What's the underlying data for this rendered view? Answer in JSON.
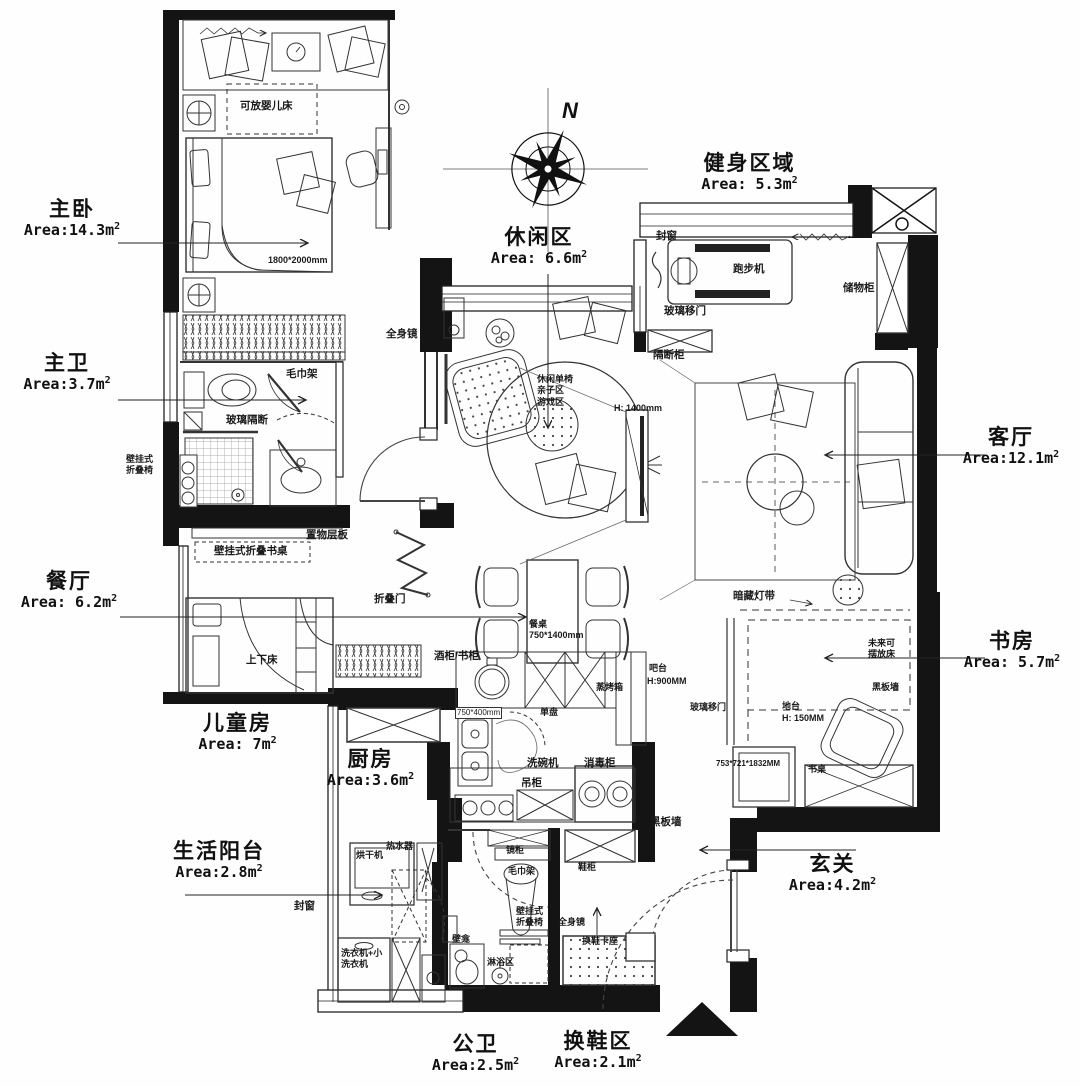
{
  "compass": {
    "north": "N"
  },
  "rooms": {
    "master_bedroom": {
      "name": "主卧",
      "area": "Area:14.3m",
      "sup": "2"
    },
    "master_bath": {
      "name": "主卫",
      "area": "Area:3.7m",
      "sup": "2"
    },
    "dining": {
      "name": "餐厅",
      "area": "Area: 6.2m",
      "sup": "2"
    },
    "kids": {
      "name": "儿童房",
      "area": "Area: 7m",
      "sup": "2"
    },
    "balcony": {
      "name": "生活阳台",
      "area": "Area:2.8m",
      "sup": "2"
    },
    "kitchen": {
      "name": "厨房",
      "area": "Area:3.6m",
      "sup": "2"
    },
    "public_bath": {
      "name": "公卫",
      "area": "Area:2.5m",
      "sup": "2"
    },
    "shoe_area": {
      "name": "换鞋区",
      "area": "Area:2.1m",
      "sup": "2"
    },
    "entry": {
      "name": "玄关",
      "area": "Area:4.2m",
      "sup": "2"
    },
    "study": {
      "name": "书房",
      "area": "Area: 5.7m",
      "sup": "2"
    },
    "living": {
      "name": "客厅",
      "area": "Area:12.1m",
      "sup": "2"
    },
    "gym": {
      "name": "健身区域",
      "area": "Area: 5.3m",
      "sup": "2"
    },
    "leisure": {
      "name": "休闲区",
      "area": "Area: 6.6m",
      "sup": "2"
    }
  },
  "annotations": {
    "crib": "可放婴儿床",
    "bed_size": "1800*2000mm",
    "full_mirror": "全身镜",
    "towel_rack": "毛巾架",
    "glass_partition": "玻璃隔断",
    "wall_chair_l1": "壁挂式",
    "wall_chair_l2": "折叠椅",
    "shelf_board": "置物层板",
    "wall_folding_desk": "壁挂式折叠书桌",
    "folding_door": "折叠门",
    "bunk_bed": "上下床",
    "wine_book_cabinet": "酒柜/书柜",
    "dining_table": "餐桌",
    "dining_table_size": "750*1400mm",
    "bar_counter": "吧台",
    "bar_height": "H:900MM",
    "steam_oven": "蒸烤箱",
    "single_basin": "单盘",
    "sink_size": "750*400mm",
    "dishwasher": "洗碗机",
    "sterilizer": "消毒柜",
    "hanging_cabinet": "吊柜",
    "blackboard_wall": "黑板墙",
    "mirror_cabinet": "镜柜",
    "shoe_cabinet": "鞋柜",
    "shoe_bench": "换鞋卡座",
    "niche": "壁龛",
    "shower_area": "淋浴区",
    "dryer": "烘干机",
    "water_heater": "热水器",
    "washer_l1": "洗衣机+小",
    "washer_l2": "洗衣机",
    "sealed_window": "封窗",
    "treadmill": "跑步机",
    "glass_sliding_door": "玻璃移门",
    "storage_cabinet": "储物柜",
    "partition_cabinet": "隔断柜",
    "leisure_chair": "休闲单椅",
    "parent_child_zone": "亲子区",
    "play_zone": "游戏区",
    "tv_height": "H: 1400mm",
    "hidden_light_strip": "暗藏灯带",
    "future_l1": "未来可",
    "future_l2": "摆放床",
    "platform": "地台",
    "platform_height": "H: 150MM",
    "cabinet_size": "753*721*1832MM",
    "desk": "书桌"
  }
}
